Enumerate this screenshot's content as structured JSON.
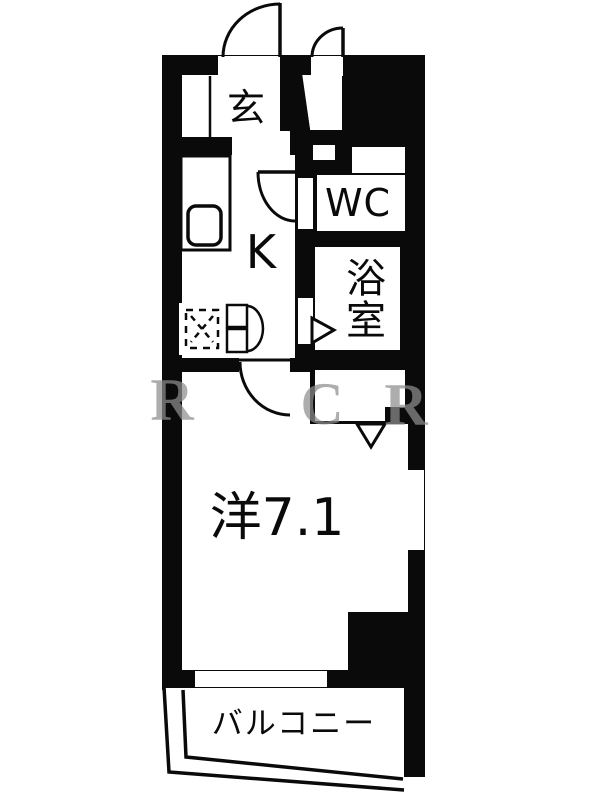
{
  "floorplan": {
    "rooms": {
      "genkan": {
        "label": "玄"
      },
      "kitchen": {
        "label": "K"
      },
      "wc": {
        "label": "WC"
      },
      "bath": {
        "label": "浴室",
        "chars": [
          "浴",
          "室"
        ]
      },
      "main": {
        "label": "洋7.1"
      },
      "balcony": {
        "label": "バルコニー"
      }
    },
    "watermark": {
      "chars": [
        "R",
        "C",
        "R"
      ]
    },
    "colors": {
      "wall": "#0a0a0a",
      "floor": "#ffffff",
      "paper": "#ffffff",
      "watermark": "#8e8e8e"
    }
  }
}
